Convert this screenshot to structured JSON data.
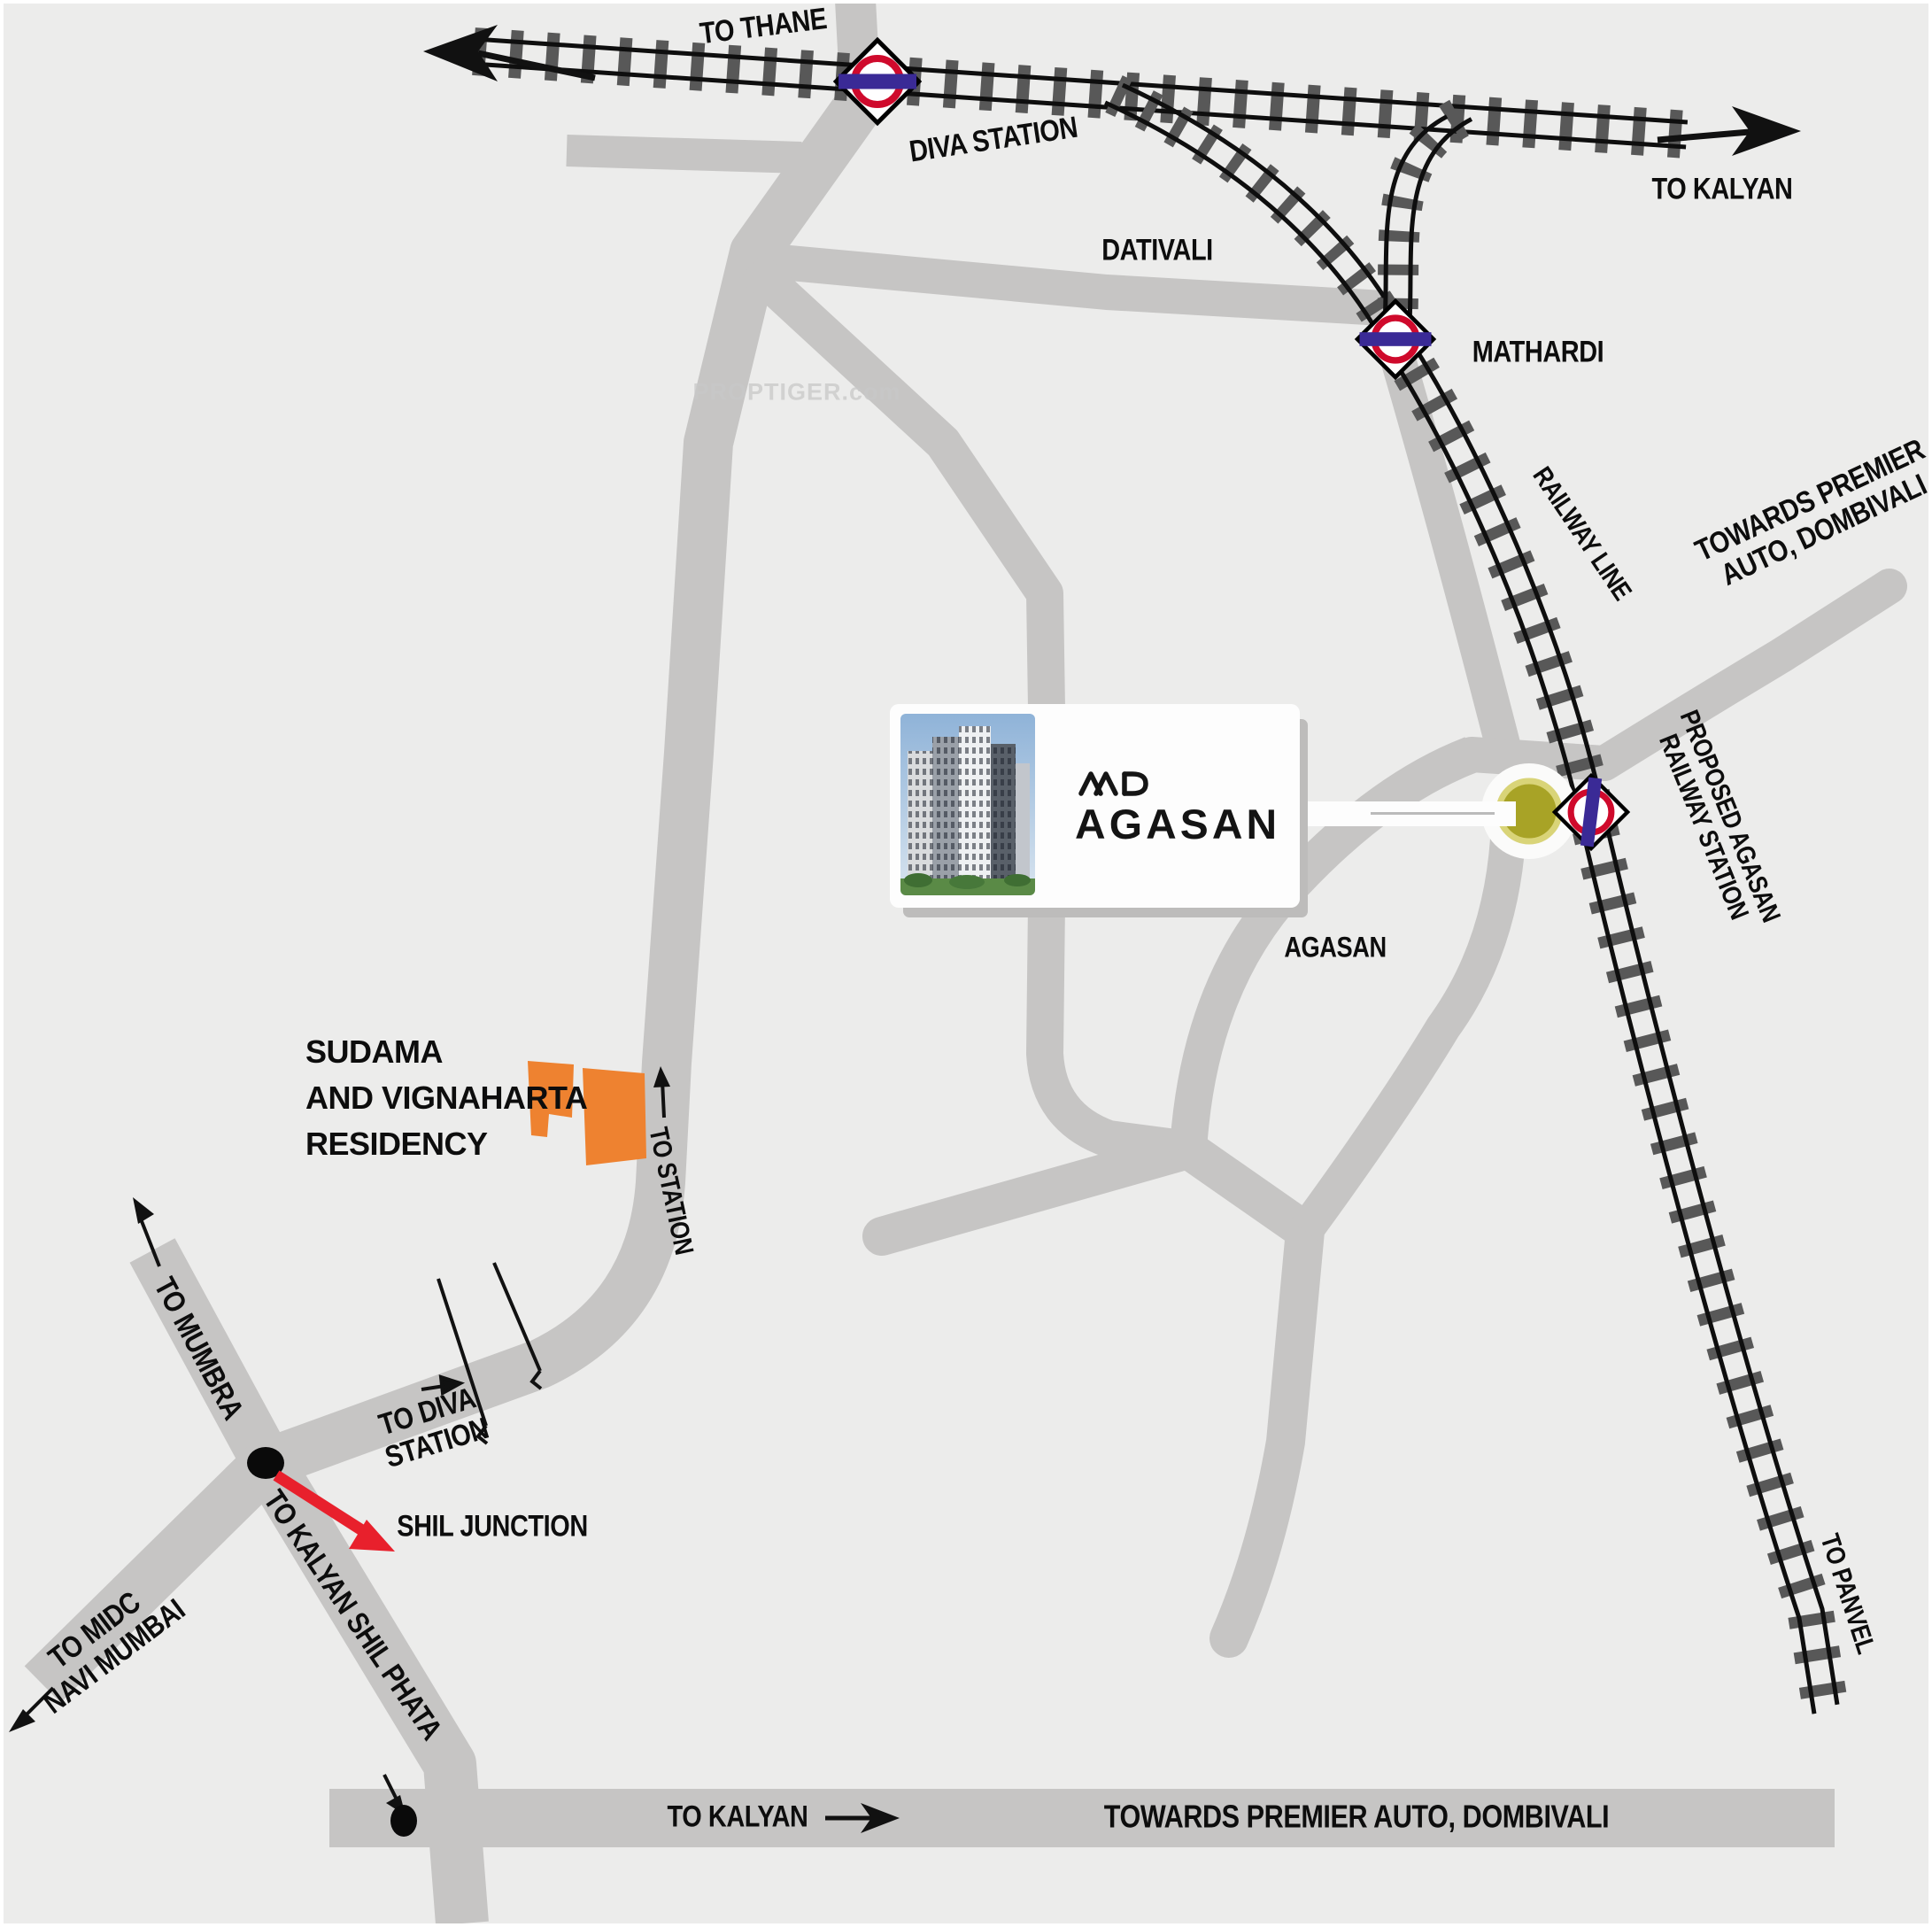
{
  "title": "AND Agasan location map",
  "labels": {
    "to_thane": "TO THANE",
    "diva_station": "DIVA STATION",
    "to_kalyan_top": "TO KALYAN",
    "dativali": "DATIVALI",
    "mathardi": "MATHARDI",
    "railway_line": "RAILWAY LINE",
    "towards_premier_top_l1": "TOWARDS PREMIER",
    "towards_premier_top_l2": "AUTO, DOMBIVALI",
    "proposed_station_l1": "PROPOSED AGASAN",
    "proposed_station_l2": "RAILWAY STATION",
    "agasan_village": "AGASAN",
    "sudama_l1": "SUDAMA",
    "sudama_l2": "AND VIGNAHARTA",
    "sudama_l3": "RESIDENCY",
    "to_station": "TO STATION",
    "to_mumbra": "TO MUMBRA",
    "shil_junction": "SHIL JUNCTION",
    "to_diva_l1": "TO DIVA",
    "to_diva_l2": "STATION",
    "to_midc_l1": "TO MIDC",
    "to_midc_l2": "NAVI MUMBAI",
    "to_kalyan_shil_phata": "TO KALYAN SHIL PHATA",
    "to_kalyan_bottom": "TO KALYAN",
    "towards_premier_bottom": "TOWARDS PREMIER AUTO, DOMBIVALI",
    "to_panvel": "TO PANVEL"
  },
  "card": {
    "brand": "AND",
    "project": "AGASAN"
  },
  "watermark": "PROPTIGER.com",
  "colors": {
    "bg": "#ececeb",
    "road": "#c6c5c4",
    "tie": "#585858",
    "rail": "#0e0e0e",
    "ring": "#cf0a2c",
    "bar": "#3a2a96",
    "red": "#e8202c",
    "orange": "#ee8230",
    "olive": "#a8a326",
    "olive_rim": "#d9d478",
    "card": "#fdfdfd",
    "ink": "#0d0d0d",
    "shadow": "#bdbcbb",
    "watermark": "#c8c8c8"
  }
}
